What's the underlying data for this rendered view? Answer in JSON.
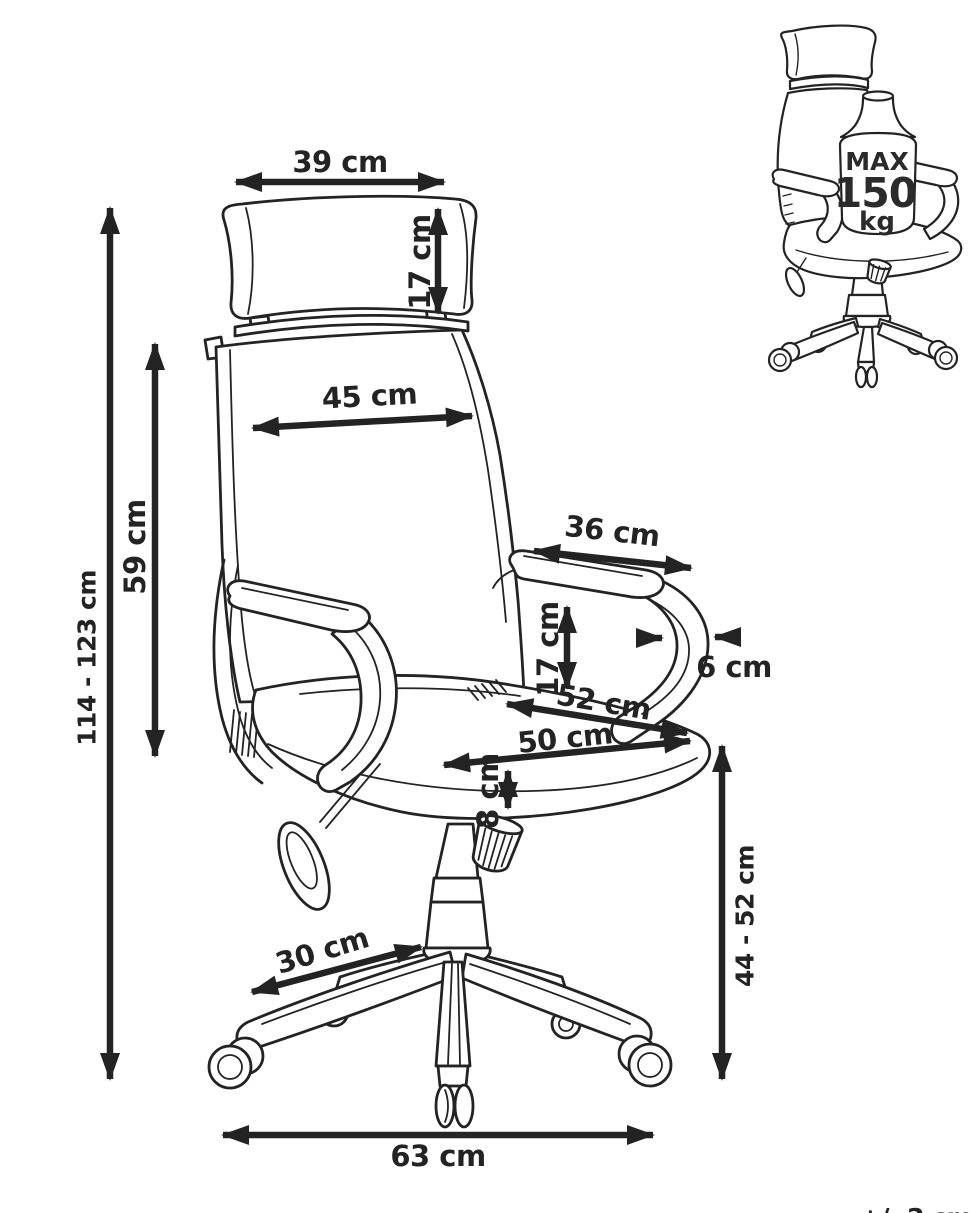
{
  "colors": {
    "line": "#232323",
    "background": "#ffffff"
  },
  "main_diagram": {
    "headrest_width": "39 cm",
    "headrest_height": "17 cm",
    "backrest_width": "45 cm",
    "backrest_height": "59 cm",
    "total_height": "114 - 123 cm",
    "armrest_length": "36 cm",
    "armrest_thickness": "6 cm",
    "armrest_height_above_seat": "17 cm",
    "seat_depth": "52 cm",
    "seat_width": "50 cm",
    "seat_cushion_thickness": "8 cm",
    "seat_height_range": "44 - 52 cm",
    "base_leg_length": "30 cm",
    "base_width": "63 cm"
  },
  "weight_limit": {
    "label_max": "MAX",
    "value": "150",
    "unit": "kg"
  },
  "footnote": {
    "tolerance": "+/- 2 cm"
  }
}
